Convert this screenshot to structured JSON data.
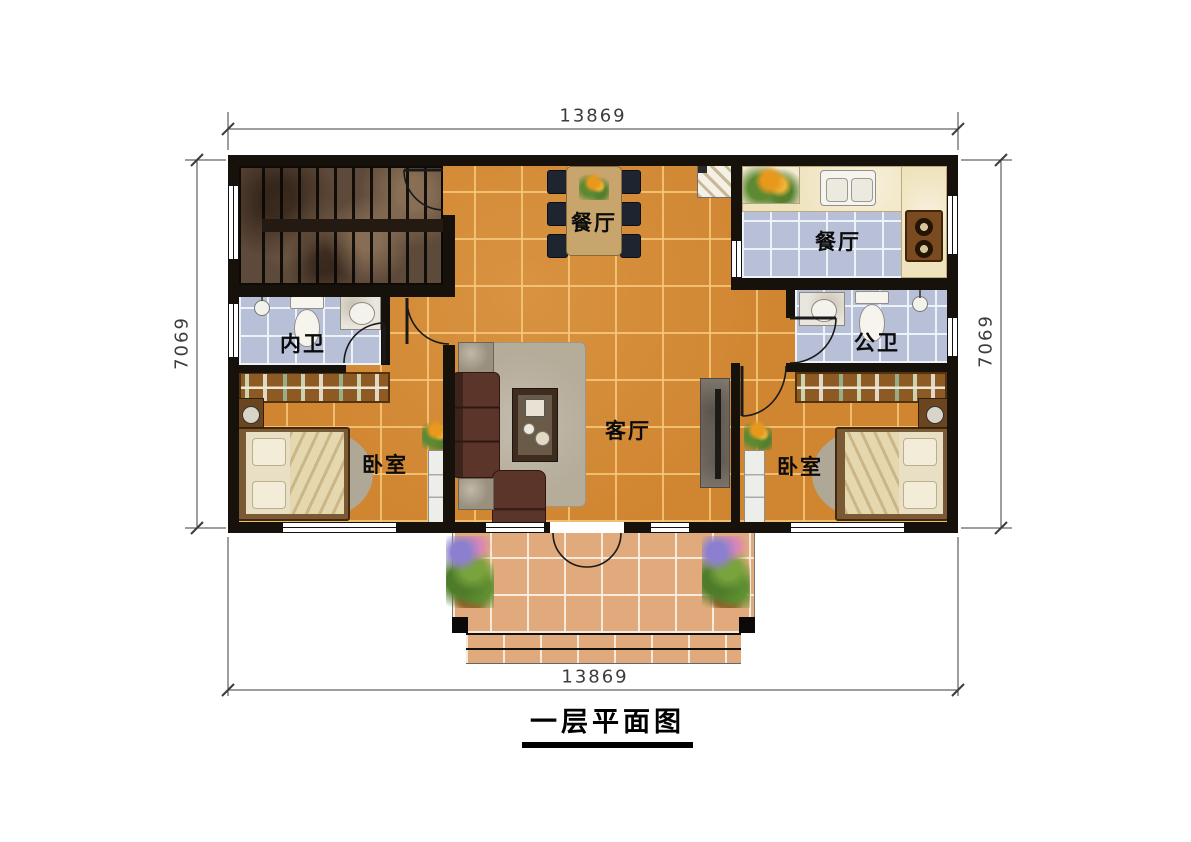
{
  "page": {
    "title": "一层平面图"
  },
  "dimensions": {
    "top": "13869",
    "bottom": "13869",
    "left": "7069",
    "right": "7069"
  },
  "rooms": {
    "dining_open": "餐厅",
    "kitchen": "餐厅",
    "inner_bath": "内卫",
    "public_bath": "公卫",
    "living": "客厅",
    "bedroom_left": "卧室",
    "bedroom_right": "卧室"
  },
  "colors": {
    "wall": "#17110b",
    "main_floor": "#d08530",
    "bath_floor": "#b7c0d6",
    "porch_floor": "#e0aa7c",
    "counter": "#efe3bd",
    "sofa": "#5c352a",
    "dining_table": "#c8a56c"
  }
}
